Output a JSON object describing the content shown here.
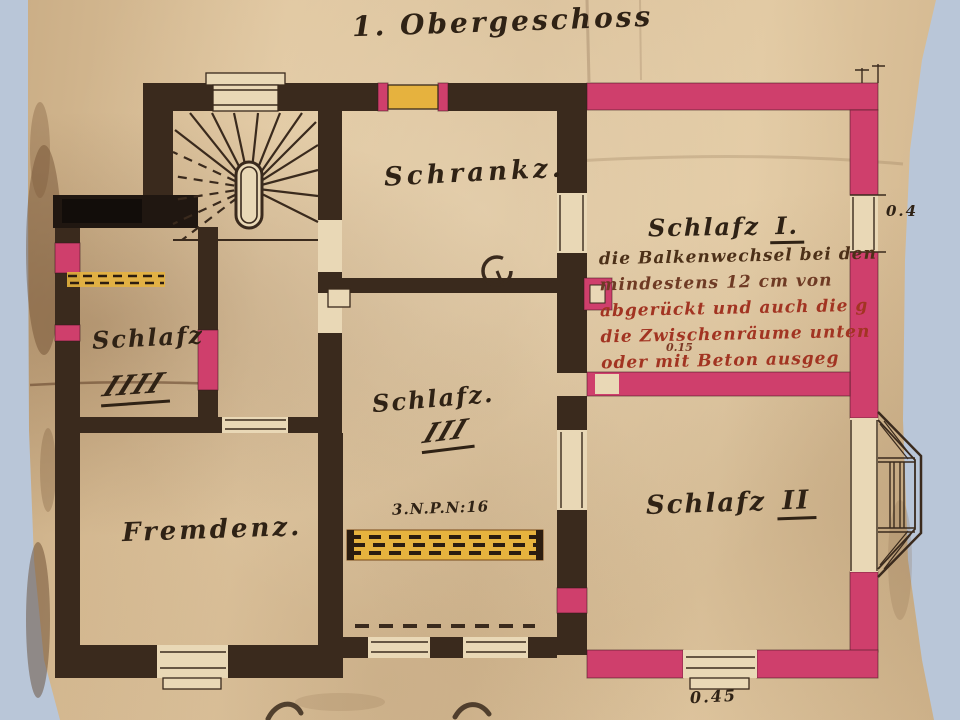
{
  "page": {
    "title": "1. Obergeschoss"
  },
  "rooms": {
    "schrank": {
      "label": "Schrankz."
    },
    "schlaf1": {
      "label": "Schlafz",
      "numeral": "I."
    },
    "schlaf2": {
      "label": "Schlafz",
      "numeral": "II"
    },
    "schlaf3": {
      "label": "Schlafz.",
      "numeral": "III"
    },
    "schlaf4": {
      "label": "Schlafz",
      "numeral": "IIII"
    },
    "fremden": {
      "label": "Fremdenz."
    }
  },
  "annotation": {
    "lines": [
      "die Balkenwechsel bei den",
      "mindestens 12 cm  von",
      "abgerückt und auch die g",
      "die Zwischenräume unten",
      "oder  mit Beton ausgeg"
    ],
    "dim": "0.15"
  },
  "dimensions": {
    "right": "0.4",
    "bottom": "0.45"
  },
  "radiator": {
    "label": "3.N.P.N:16"
  },
  "colors": {
    "wall_dark": "#3a2a1d",
    "wall_pink": "#cf3f6c",
    "fitting_yellow": "#e6b23e",
    "paper_light": "#e9d8b6",
    "ink": "#2f2215",
    "red_ink": "#a23422"
  }
}
